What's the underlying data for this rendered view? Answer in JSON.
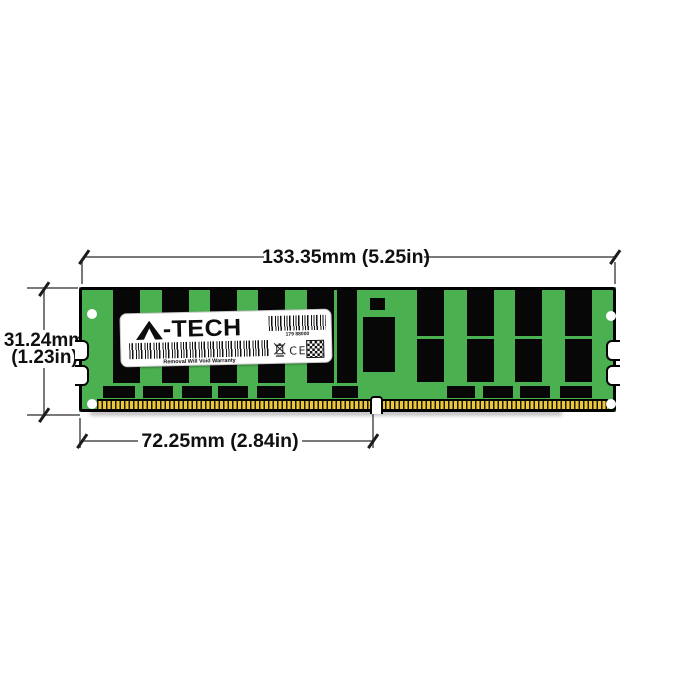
{
  "annotations": {
    "width_label": "133.35mm (5.25in)",
    "height_label_line1": "31.24mm",
    "height_label_line2": "(1.23in)",
    "pin_span_label": "72.25mm (2.84in)",
    "line_color": "#7a7a7a",
    "text_color": "#101010"
  },
  "module": {
    "colors": {
      "pcb_green": "#4bb150",
      "chip_black": "#070707",
      "pin_gold": "#e9c73e",
      "outline": "#000000"
    },
    "label": {
      "brand_text": "-TECH",
      "serial_text": "179 88000",
      "warranty_text": "Removal Will Void Warranty",
      "ce_text": "CE"
    },
    "chips": {
      "tall_columns": [
        {
          "x": 34
        },
        {
          "x": 83
        },
        {
          "x": 131
        },
        {
          "x": 179
        },
        {
          "x": 228
        },
        {
          "x": 258,
          "w": 20
        }
      ],
      "paired_columns_x": [
        338,
        388,
        436,
        486
      ],
      "small_bottom": [
        {
          "x": 24,
          "w": 32
        },
        {
          "x": 64,
          "w": 30
        },
        {
          "x": 103,
          "w": 30
        },
        {
          "x": 139,
          "w": 30
        },
        {
          "x": 178,
          "w": 28
        },
        {
          "x": 253,
          "w": 26
        },
        {
          "x": 368,
          "w": 28
        },
        {
          "x": 404,
          "w": 30
        },
        {
          "x": 441,
          "w": 30
        },
        {
          "x": 481,
          "w": 32
        }
      ],
      "center_small": {
        "x": 291,
        "y": 11,
        "w": 15,
        "h": 12
      },
      "register": {
        "x": 284,
        "y": 30,
        "w": 32,
        "h": 55
      }
    },
    "holes": [
      {
        "x": 8,
        "y": 22
      },
      {
        "x": 8,
        "y": 112
      },
      {
        "x": 527,
        "y": 24
      },
      {
        "x": 527,
        "y": 112
      }
    ],
    "edge_notches": {
      "left": [
        53,
        78
      ],
      "right": [
        53,
        78
      ]
    }
  }
}
